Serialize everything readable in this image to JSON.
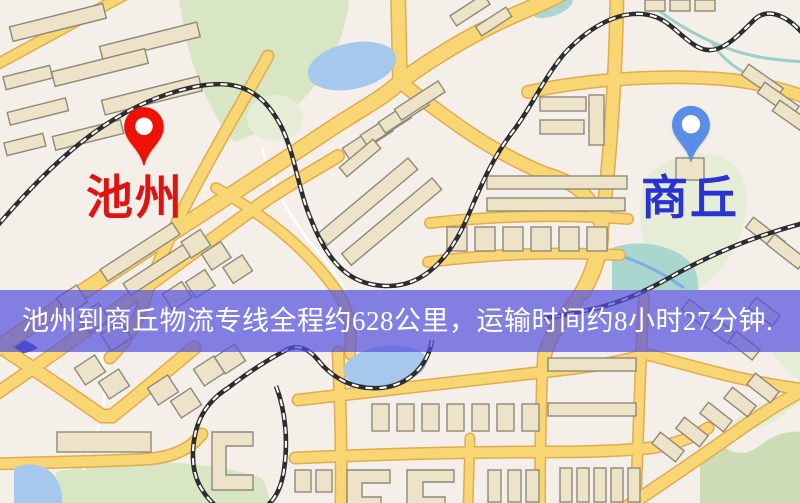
{
  "markers": {
    "origin": {
      "label": "池州",
      "label_color": "#e11310",
      "pin_color": "#ee1205"
    },
    "destination": {
      "label": "商丘",
      "label_color": "#2833d2",
      "pin_color": "#5a8ce8"
    }
  },
  "banner": {
    "text": "池州到商丘物流专线全程约628公里，运输时间约8小时27分钟.",
    "background_color": "rgba(82,80,222,0.70)",
    "text_color": "#ffffff"
  },
  "route": {
    "origin_name": "池州",
    "destination_name": "商丘",
    "distance_text": "628公里",
    "duration_text": "8小时27分钟"
  },
  "map": {
    "colors": {
      "background": "#f4efe9",
      "road": "#f8d673",
      "road_border": "#e4aa50",
      "building": "#ece3c8",
      "building_outline": "#8f897a",
      "park": "#d9e6c4",
      "park_light": "#e5edd6",
      "park_dark": "#cddcb4",
      "water": "#a5c8ec",
      "water_teal": "#a9d6ce",
      "railway": "#2d2d2d",
      "railway_dash": "#ffffff",
      "stream": "#9ccfc6"
    }
  }
}
